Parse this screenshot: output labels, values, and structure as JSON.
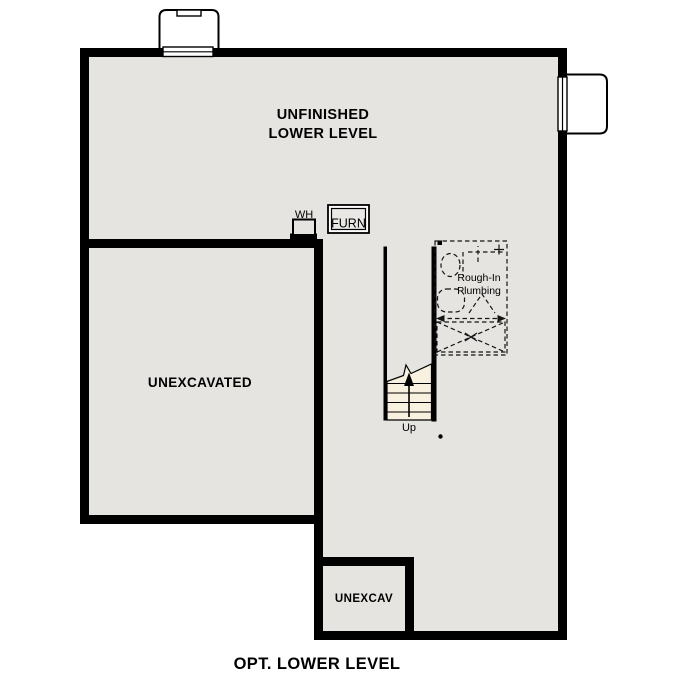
{
  "plan": {
    "title": "OPT. LOWER LEVEL",
    "rooms": {
      "main": {
        "label_line1": "UNFINISHED",
        "label_line2": "LOWER LEVEL"
      },
      "unexcavated": {
        "label": "UNEXCAVATED"
      },
      "unexcav": {
        "label": "UNEXCAV"
      }
    },
    "fixtures": {
      "water_heater": {
        "label": "WH"
      },
      "furnace": {
        "label": "FURN"
      },
      "rough_in_plumbing": {
        "label_line1": "Rough-In",
        "label_line2": "Plumbing"
      },
      "stairs": {
        "direction_label": "Up"
      }
    },
    "colors": {
      "wall": "#000000",
      "floor": "#e5e4e1",
      "stairs_fill": "#f8f1df",
      "outside": "#ffffff",
      "text": "#000000"
    }
  }
}
